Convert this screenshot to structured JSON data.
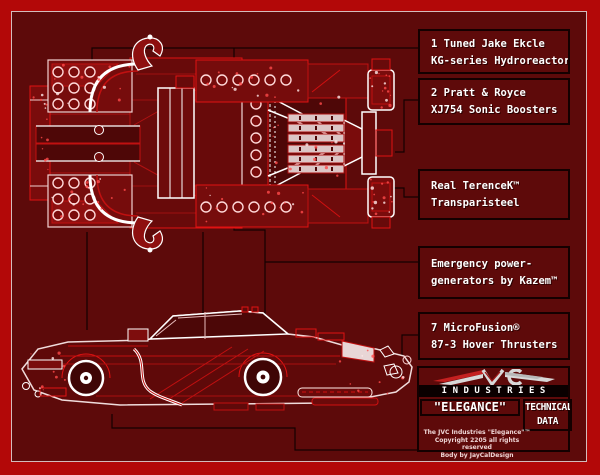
{
  "callouts": [
    {
      "id": "hydroreactor",
      "line1": "1 Tuned Jake Ekcle",
      "line2": "KG-series Hydroreactor"
    },
    {
      "id": "sonic-boosters",
      "line1": "2 Pratt & Royce",
      "line2": "XJ754 Sonic Boosters"
    },
    {
      "id": "transparisteel",
      "line1": "Real TerenceK™",
      "line2": "Transparisteel"
    },
    {
      "id": "power-generators",
      "line1": "Emergency power-",
      "line2": "generators by Kazem™"
    },
    {
      "id": "hover-thrusters",
      "line1": "7 MicroFusion®",
      "line2": "87-3 Hover Thrusters"
    }
  ],
  "logo": {
    "company": "JVC",
    "industries": "INDUSTRIES",
    "model_name": "\"ELEGANCE\"",
    "technical_line1": "TECHNICAL",
    "technical_line2": "DATA",
    "fine_print": [
      "The JVC Industries \"Elegance\"™",
      "Copyright 2205 all rights reserved",
      "Body by JayCalDesign"
    ]
  },
  "colors": {
    "frame_red": "#b30808",
    "background": "#5d0a0a",
    "line_red": "#e01212",
    "highlight_white": "#ffffff",
    "connector_black": "#140000",
    "text_white": "#ffffff"
  }
}
